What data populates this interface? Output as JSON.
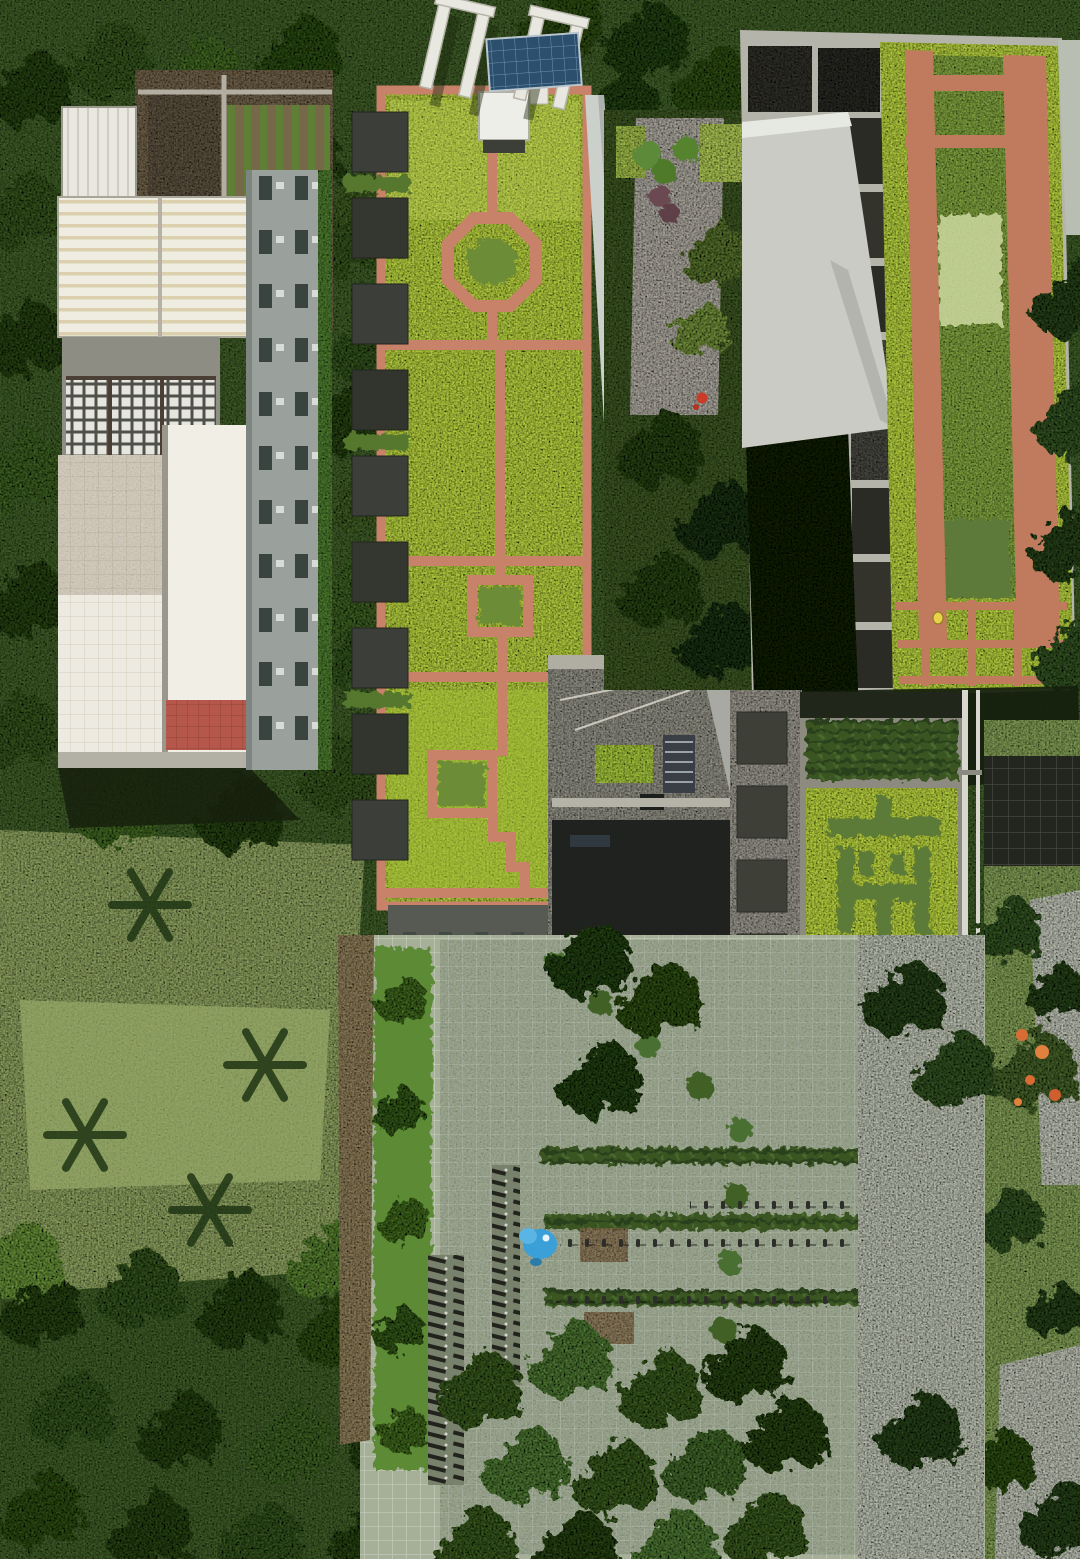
{
  "meta": {
    "scene": "aerial-drone-photograph",
    "description": "Top-down aerial view of campus buildings with extensive green roofs: a long sedum roof crossed by red-brick paths, a striped green-and-brick roof with dark water cells, a white-roofed block with rooftop vegetable garden, and a long roof whose plantings spell a Chinese motto; dense tree canopy, lawns, and a paved plaza with bicycle rows, standing people and a blue object below.",
    "canvas": {
      "width": 1080,
      "height": 1559
    }
  },
  "roof_motto": {
    "phrase": "南方之强",
    "panels": [
      {
        "char": "南",
        "foliage": "dark-green plants on light-green sedum"
      },
      {
        "char": "方",
        "foliage": "pale whitish plants on light-green sedum"
      },
      {
        "char": "之",
        "foliage": "pale whitish plants on light-green sedum"
      },
      {
        "char": "强",
        "foliage": "dark-green plants on light-green sedum"
      }
    ]
  },
  "regions": {
    "background": {
      "label": "dense tree canopy, lawns and garden paths"
    },
    "left_building": {
      "label": "white-roofed block with rooftop vegetable garden, sheds and lattice terrace"
    },
    "central_building": {
      "label": "long sedum green roof with red-brick paths, octagon ring and planter squares"
    },
    "upper_right_building": {
      "label": "green roof with wide brick strips, mixed planting band and dark water cells"
    },
    "connector_building": {
      "label": "low concrete roof with HVAC unit and small green patch"
    },
    "motto_building": {
      "label": "long roof with four planted panels spelling the motto, hedge panel and mixed-color panel"
    },
    "plaza": {
      "label": "grass-grid paver plaza with hedge rows, parked bicycles, people in rows and a blue object"
    },
    "middle_courtyard": {
      "label": "courtyard path with round topiary, purple shrubs and a red flower"
    },
    "right_grounds": {
      "label": "lawn, flame tree with orange blossoms, pavements and dark mats"
    }
  },
  "palette": {
    "sedum_light": "#b2cc40",
    "brick_path": "#c9826a",
    "hedge_dark": "#3f5c28",
    "canopy_dark": "#33511f",
    "pale_plants": "#e3ebc8",
    "char_dark_green": "#5b7a38",
    "plaza_paver": "#a6b098",
    "concrete": "#a8a69c",
    "white_roof": "#efece2",
    "red_tile": "#b5574a",
    "solar_blue": "#2c4f6e",
    "object_blue": "#3b9fd8",
    "flame_orange": "#d96b35",
    "person_yellow": "#e8d24a"
  }
}
